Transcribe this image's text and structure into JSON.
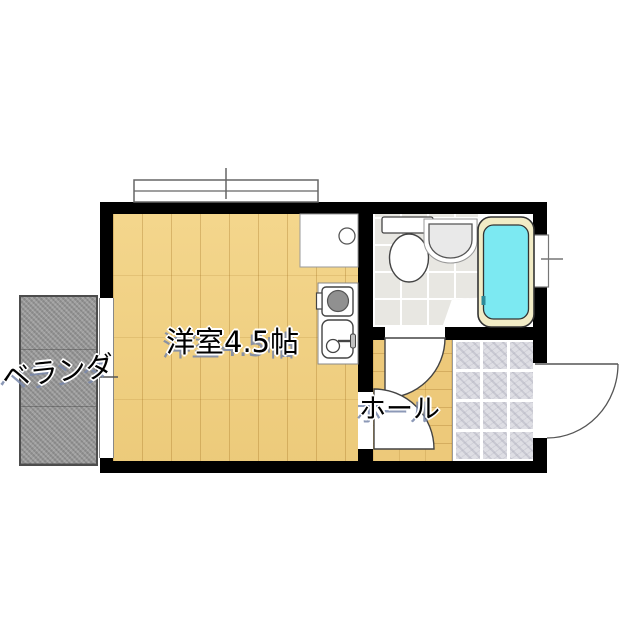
{
  "floorplan": {
    "labels": {
      "main_room": "洋室4.5帖",
      "hall": "ホール",
      "veranda": "ベランダ"
    },
    "rooms": [
      {
        "id": "main-room",
        "label": "洋室4.5帖",
        "floor": "wood"
      },
      {
        "id": "hall",
        "label": "ホール",
        "floor": "wood"
      },
      {
        "id": "veranda",
        "label": "ベランダ",
        "floor": "concrete"
      },
      {
        "id": "washroom",
        "label": "",
        "floor": "tile"
      },
      {
        "id": "entry-genkan",
        "label": "",
        "floor": "stone-tile"
      }
    ],
    "fixtures": [
      "bathtub",
      "toilet",
      "wash-basin",
      "counter",
      "kitchen-stove",
      "kitchen-sink",
      "entry-door",
      "washroom-door",
      "room-door",
      "window-top",
      "window-right",
      "veranda-window"
    ],
    "colors": {
      "wall": "#000000",
      "wood_floor": "#f0cf7f",
      "hall_floor": "#edc97a",
      "veranda_concrete": "#9c9c9c",
      "bath_tile": "#e8e7e2",
      "genkan_tile": "#dedee4",
      "bathtub_water": "#7ce9f2",
      "bathtub_rim": "#f2ecc6",
      "burner": "#909090",
      "text": "#000000",
      "text_outline": "#ffffff",
      "text_shadow": "#7887aa"
    }
  }
}
